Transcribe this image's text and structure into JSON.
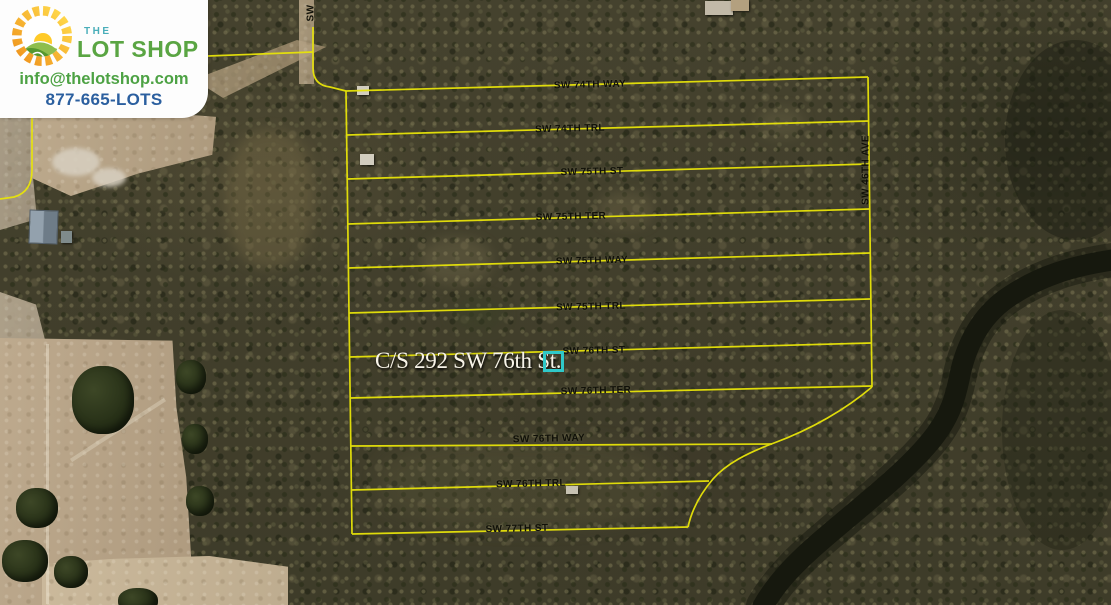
{
  "branding": {
    "the_label": "THE",
    "name_label": "LOT SHOP",
    "email": "info@thelotshop.com",
    "phone": "877-665-LOTS"
  },
  "colors": {
    "brand_green": "#5aa543",
    "brand_teal": "#49aeb9",
    "email_green": "#4da244",
    "phone_blue": "#2b5f9f",
    "boundary_yellow": "#e8e409",
    "highlight_cyan": "#2fc9c9",
    "street_text": "#101008"
  },
  "map": {
    "highlight_label": "C/S 292 SW 76th St.",
    "streets": [
      {
        "label": "SW 74TH WAY"
      },
      {
        "label": "SW 74TH TRL"
      },
      {
        "label": "SW 75TH ST"
      },
      {
        "label": "SW 75TH TER"
      },
      {
        "label": "SW 75TH WAY"
      },
      {
        "label": "SW 75TH TRL"
      },
      {
        "label": "SW 76TH ST"
      },
      {
        "label": "SW 76TH TER"
      },
      {
        "label": "SW 76TH WAY"
      },
      {
        "label": "SW 76TH TRL"
      },
      {
        "label": "SW 77TH ST"
      }
    ],
    "vertical_streets": [
      {
        "label": "SW 46TH AVE"
      },
      {
        "label": "SW"
      }
    ]
  }
}
